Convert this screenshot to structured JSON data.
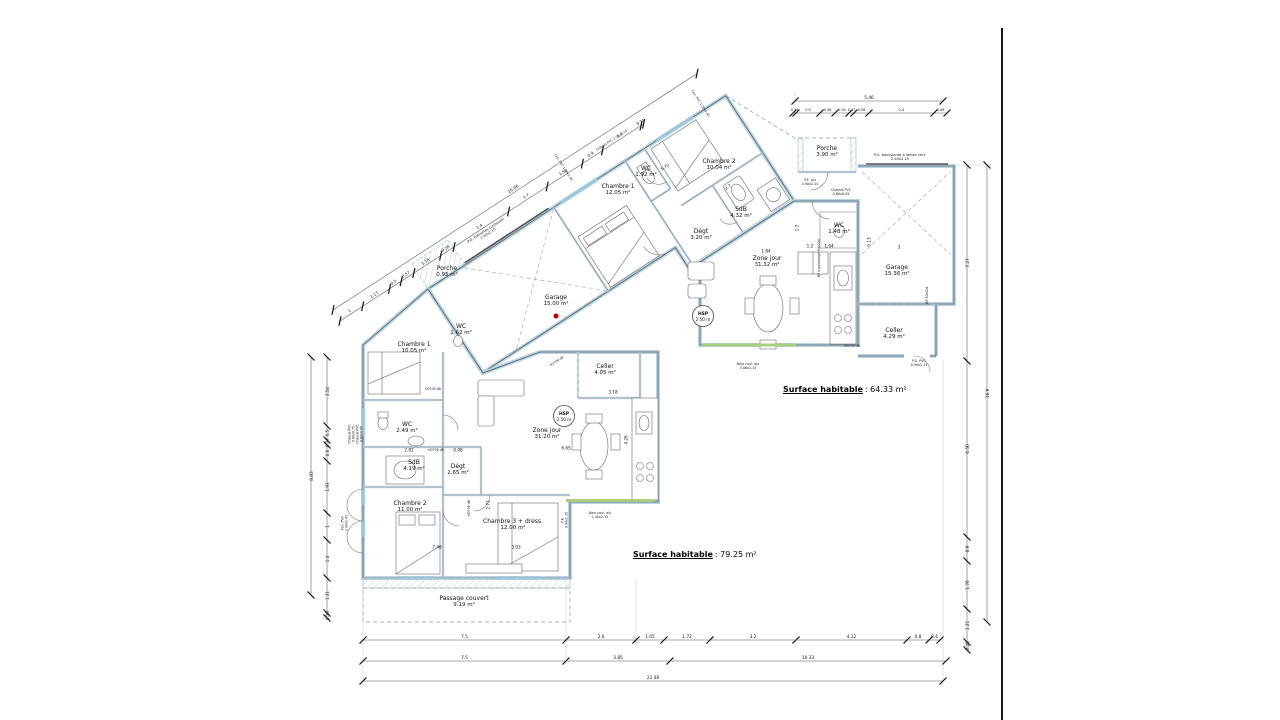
{
  "colors": {
    "wall_fill": "#b9d4e3",
    "wall_line": "#4e5a61",
    "dim_line": "#444444",
    "green_bay": "#a8cf7f",
    "red_dot": "#c00000",
    "sheet_edge": "#141414",
    "hatch": "#c2dbe8"
  },
  "surfaces": [
    {
      "label": "Surface habitable",
      "value": ": 64.33 m²"
    },
    {
      "label": "Surface habitable",
      "value": ": 79.25 m²"
    }
  ],
  "red_dot": {
    "x": 556,
    "y": 316
  },
  "rooms": [
    {
      "name": "Porche",
      "area": "0.95 m²",
      "x": 447,
      "y": 272
    },
    {
      "name": "Garage",
      "area": "15.00 m²",
      "x": 556,
      "y": 301
    },
    {
      "name": "Chambre 1",
      "area": "12.05 m²",
      "x": 618,
      "y": 190
    },
    {
      "name": "WC",
      "area": "1.92 m²",
      "x": 646,
      "y": 172
    },
    {
      "name": "Chambre 2",
      "area": "10.04 m²",
      "x": 719,
      "y": 165
    },
    {
      "name": "SdB",
      "area": "4.32 m²",
      "x": 741,
      "y": 213
    },
    {
      "name": "Dégt",
      "area": "3.20 m²",
      "x": 701,
      "y": 235
    },
    {
      "name": "Zone jour",
      "area": "31.32 m²",
      "x": 767,
      "y": 262
    },
    {
      "name": "Porche",
      "area": "3.90 m²",
      "x": 827,
      "y": 152
    },
    {
      "name": "WC",
      "area": "1.48 m²",
      "x": 839,
      "y": 229
    },
    {
      "name": "Garage",
      "area": "15.36 m²",
      "x": 897,
      "y": 271
    },
    {
      "name": "Celler",
      "area": "4.29 m²",
      "x": 894,
      "y": 334
    },
    {
      "name": "Chambre 1",
      "area": "10.05 m²",
      "x": 414,
      "y": 348
    },
    {
      "name": "WC",
      "area": "1.62 m²",
      "x": 461,
      "y": 330
    },
    {
      "name": "WC",
      "area": "2.49 m²",
      "x": 407,
      "y": 428
    },
    {
      "name": "SdB",
      "area": "4.19 m²",
      "x": 414,
      "y": 466
    },
    {
      "name": "Dégt",
      "area": "2.65 m²",
      "x": 458,
      "y": 470
    },
    {
      "name": "Chambre 2",
      "area": "11.00 m²",
      "x": 410,
      "y": 507
    },
    {
      "name": "Chambre 3 + dress.",
      "area": "12.00 m²",
      "x": 513,
      "y": 525
    },
    {
      "name": "Zone jour",
      "area": "31.20 m²",
      "x": 547,
      "y": 434
    },
    {
      "name": "Celler",
      "area": "4.05 m²",
      "x": 605,
      "y": 370
    },
    {
      "name": "Passage couvert",
      "area": "9.19 m²",
      "x": 464,
      "y": 602
    }
  ],
  "hsp": [
    {
      "title": "HSP",
      "value": "2.50 m",
      "x": 703,
      "y": 316
    },
    {
      "title": "HSP",
      "value": "2.50 m",
      "x": 564,
      "y": 416
    }
  ],
  "annotations": [
    {
      "lines": [
        "P.G. basculante à lames vert.",
        "2.40x2.15"
      ],
      "x": 900,
      "y": 157,
      "r": 0,
      "s": 3.6
    },
    {
      "lines": [
        "P.E. alu",
        "0.90x2.15"
      ],
      "x": 810,
      "y": 183,
      "r": 0,
      "s": 3.3
    },
    {
      "lines": [
        "Châssis PVC",
        "0.60x0.95"
      ],
      "x": 841,
      "y": 193,
      "r": 0,
      "s": 3.3
    },
    {
      "lines": [
        "BP à galandage 80x204"
      ],
      "x": 820,
      "y": 258,
      "r": -90,
      "s": 3.2
    },
    {
      "lines": [
        "BP 80x204"
      ],
      "x": 928,
      "y": 295,
      "r": -90,
      "s": 3.2
    },
    {
      "lines": [
        "P.G. PVC",
        "0.90x2.15"
      ],
      "x": 919,
      "y": 364,
      "r": 0,
      "s": 3.3
    },
    {
      "lines": [
        "Baie coul. alu",
        "3.06x2.15"
      ],
      "x": 748,
      "y": 367,
      "r": 0,
      "s": 3.3
    },
    {
      "lines": [
        "Baie coul. alu",
        "2.40x2.15"
      ],
      "x": 600,
      "y": 516,
      "r": 0,
      "s": 3.3
    },
    {
      "lines": [
        "P.G. battantes coulissant",
        "2.40x2.15"
      ],
      "x": 487,
      "y": 232,
      "r": -33,
      "s": 3.5
    },
    {
      "lines": [
        "Châssis PVC 2.00x0.15"
      ],
      "x": 612,
      "y": 141,
      "r": -33,
      "s": 3.2
    },
    {
      "lines": [
        "Fen. PVC 1.00x1.45"
      ],
      "x": 563,
      "y": 168,
      "r": 57,
      "s": 3.2
    },
    {
      "lines": [
        "Fen. PVC 1.00x1.45"
      ],
      "x": 700,
      "y": 104,
      "r": 57,
      "s": 3.2
    },
    {
      "lines": [
        "Châssis PVC",
        "0.60x0.75"
      ],
      "x": 352,
      "y": 434,
      "r": -90,
      "s": 3.2
    },
    {
      "lines": [
        "Châssis PVC",
        "0.60x0.95"
      ],
      "x": 360,
      "y": 434,
      "r": -90,
      "s": 3.2
    },
    {
      "lines": [
        "Fen. PVC",
        "1.00x1.45"
      ],
      "x": 345,
      "y": 523,
      "r": -90,
      "s": 3.2
    },
    {
      "lines": [
        "H0709 dB"
      ],
      "x": 433,
      "y": 390,
      "r": 0,
      "s": 3.2
    },
    {
      "lines": [
        "H0709 dB"
      ],
      "x": 436,
      "y": 451,
      "r": 0,
      "s": 3.2
    },
    {
      "lines": [
        "H0709 dB"
      ],
      "x": 470,
      "y": 508,
      "r": -90,
      "s": 3.2
    },
    {
      "lines": [
        "H0709 dB"
      ],
      "x": 852,
      "y": 347,
      "r": 0,
      "s": 3.2
    },
    {
      "lines": [
        "H0709 dB"
      ],
      "x": 557,
      "y": 362,
      "r": -33,
      "s": 3.2
    },
    {
      "lines": [
        "P.E.",
        "0.90x2.15"
      ],
      "x": 565,
      "y": 520,
      "r": -90,
      "s": 3.2
    }
  ],
  "extra_dims": [
    {
      "v": "1.84",
      "x": 766,
      "y": 251,
      "r": 0
    },
    {
      "v": "1.2",
      "x": 810,
      "y": 246,
      "r": 0
    },
    {
      "v": "1.94",
      "x": 829,
      "y": 246,
      "r": 0
    },
    {
      "v": "1.7",
      "x": 797,
      "y": 228,
      "r": -90
    },
    {
      "v": "5.13",
      "x": 869,
      "y": 242,
      "r": -90
    },
    {
      "v": "3",
      "x": 899,
      "y": 247,
      "r": 0
    },
    {
      "v": "3.18",
      "x": 613,
      "y": 392,
      "r": 0
    },
    {
      "v": "4.26",
      "x": 626,
      "y": 440,
      "r": -90
    },
    {
      "v": "6.65",
      "x": 566,
      "y": 448,
      "r": 0
    },
    {
      "v": "2.82",
      "x": 409,
      "y": 450,
      "r": 0
    },
    {
      "v": "0.98",
      "x": 458,
      "y": 450,
      "r": 0
    },
    {
      "v": "2.71",
      "x": 488,
      "y": 505,
      "r": -90
    },
    {
      "v": "3.03",
      "x": 516,
      "y": 547,
      "r": 0
    },
    {
      "v": "7.48",
      "x": 437,
      "y": 547,
      "r": 0
    },
    {
      "v": "5.72",
      "x": 665,
      "y": 167,
      "r": -33
    },
    {
      "v": "2.7",
      "x": 728,
      "y": 187,
      "r": -33
    }
  ],
  "dim_chains": [
    {
      "name": "bottom-row-1",
      "x": 363,
      "y": 640,
      "a": 0,
      "fs": 4.3,
      "flip": false,
      "segs": [
        [
          "7.5",
          203
        ],
        [
          "2.6",
          70
        ],
        [
          "1.05",
          28
        ],
        [
          "1.72",
          46
        ],
        [
          "3.2",
          86
        ],
        [
          "4.12",
          111
        ],
        [
          "0.8",
          22
        ],
        [
          "0.4",
          11
        ]
      ]
    },
    {
      "name": "bottom-row-2",
      "x": 363,
      "y": 661,
      "a": 0,
      "fs": 4.3,
      "flip": false,
      "segs": [
        [
          "7.5",
          203
        ],
        [
          "3.85",
          104
        ],
        [
          "10.33",
          276
        ]
      ]
    },
    {
      "name": "bottom-row-3",
      "x": 363,
      "y": 681,
      "a": 0,
      "fs": 4.3,
      "flip": false,
      "segs": [
        [
          "21.48",
          580
        ]
      ]
    },
    {
      "name": "right-inner",
      "x": 967,
      "y": 165,
      "a": 90,
      "fs": 4.3,
      "flip": true,
      "segs": [
        [
          "7.27",
          196
        ],
        [
          "6.50",
          176
        ],
        [
          "0.9",
          24
        ],
        [
          "1.76",
          48
        ],
        [
          "1.21",
          33
        ],
        [
          "0.28",
          8
        ]
      ]
    },
    {
      "name": "right-outer",
      "x": 987,
      "y": 165,
      "a": 90,
      "fs": 4.3,
      "flip": true,
      "segs": [
        [
          "16.9",
          457
        ]
      ]
    },
    {
      "name": "top-right-outer",
      "x": 795,
      "y": 101,
      "a": 0,
      "fs": 4.3,
      "flip": false,
      "segs": [
        [
          "5.46",
          148
        ]
      ]
    },
    {
      "name": "top-right-inner",
      "x": 793,
      "y": 113,
      "a": 0,
      "fs": 3.4,
      "flip": false,
      "segs": [
        [
          "0.11",
          3
        ],
        [
          "0.9",
          24
        ],
        [
          "0.56",
          15
        ],
        [
          "0.50",
          14
        ],
        [
          "0.17",
          5
        ],
        [
          "0.56",
          15
        ],
        [
          "2.4",
          65
        ],
        [
          "0.49",
          13
        ]
      ]
    },
    {
      "name": "diagonal-outer",
      "x": 333,
      "y": 310,
      "a": -33,
      "fs": 4.3,
      "flip": false,
      "segs": [
        [
          "16.06",
          434
        ]
      ]
    },
    {
      "name": "diagonal-inner",
      "x": 340,
      "y": 321,
      "a": -33,
      "fs": 4.0,
      "flip": false,
      "segs": [
        [
          "1",
          27
        ],
        [
          "1.17",
          32
        ],
        [
          "0.5",
          14
        ],
        [
          "0.57",
          15
        ],
        [
          "1.18",
          32
        ],
        [
          "0.58",
          16
        ],
        [
          "2.4",
          65
        ],
        [
          "1.7",
          46
        ],
        [
          "1.56",
          42
        ],
        [
          "0.9",
          24
        ],
        [
          "1.7",
          46
        ],
        [
          "0.11",
          3
        ]
      ]
    },
    {
      "name": "left-inner",
      "x": 327,
      "y": 357,
      "a": 90,
      "fs": 4.0,
      "flip": true,
      "segs": [
        [
          "2.54",
          69
        ],
        [
          "0.5",
          14
        ],
        [
          "0.17",
          5
        ],
        [
          "0.6",
          16
        ],
        [
          "1.93",
          52
        ],
        [
          "1",
          27
        ],
        [
          "1.4",
          38
        ],
        [
          "1.31",
          35
        ],
        [
          "0.18",
          5
        ]
      ]
    },
    {
      "name": "left-outer",
      "x": 311,
      "y": 357,
      "a": 90,
      "fs": 4.3,
      "flip": true,
      "segs": [
        [
          "8.83",
          238
        ]
      ]
    }
  ]
}
